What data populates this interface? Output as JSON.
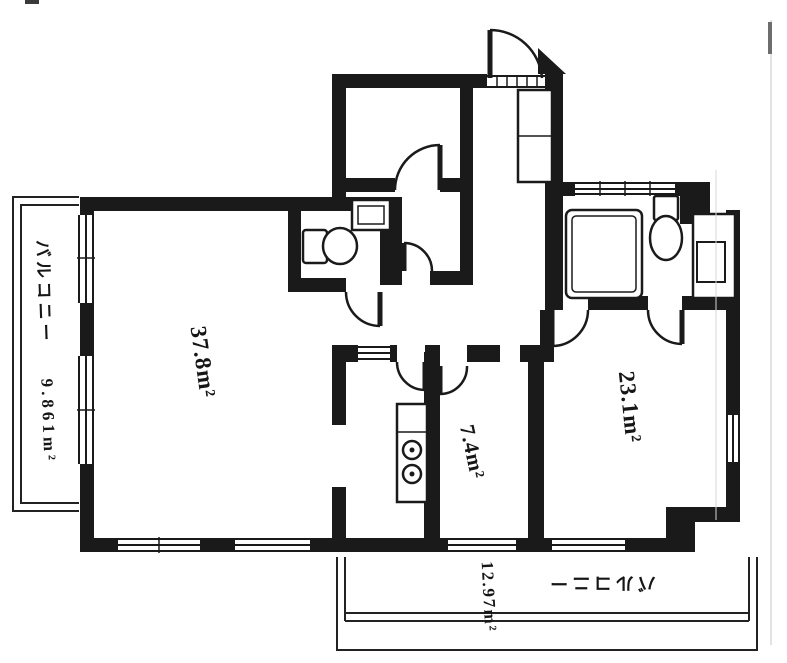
{
  "plan": {
    "ink_color": "#1a1a1a",
    "rooms": [
      {
        "id": "living-dining",
        "area_label": "37.8m²"
      },
      {
        "id": "bedroom-right",
        "area_label": "23.1m²"
      },
      {
        "id": "dining-kitchen",
        "area_label": "7.4m²"
      }
    ],
    "balconies": [
      {
        "id": "balcony-left",
        "name_label": "バルコニー",
        "area_label": "9.861m²"
      },
      {
        "id": "balcony-bottom",
        "name_label": "バルコニー",
        "area_label": "12.97m²"
      }
    ]
  }
}
